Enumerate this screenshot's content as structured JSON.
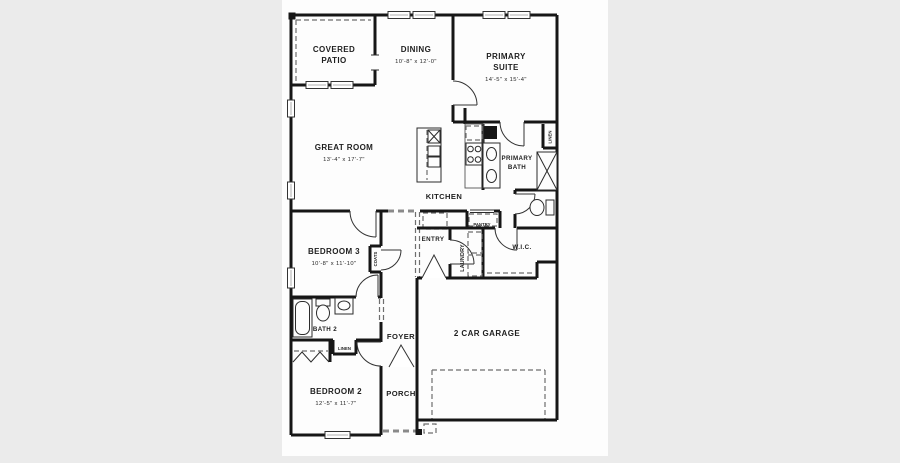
{
  "canvas": {
    "background": "#ebebeb",
    "paper": "#fdfdfd",
    "wall_color": "#161616",
    "text_color": "#1f1f1f"
  },
  "rooms": {
    "covered_patio": {
      "line1": "COVERED",
      "line2": "PATIO"
    },
    "dining": {
      "name": "DINING",
      "dims": "10'-8\" x 12'-0\""
    },
    "primary_suite": {
      "line1": "PRIMARY",
      "line2": "SUITE",
      "dims": "14'-5\" x 15'-4\""
    },
    "great_room": {
      "name": "GREAT ROOM",
      "dims": "13'-4\" x 17'-7\""
    },
    "kitchen": {
      "name": "KITCHEN"
    },
    "primary_bath": {
      "line1": "PRIMARY",
      "line2": "BATH"
    },
    "bedroom3": {
      "name": "BEDROOM 3",
      "dims": "10'-8\" x 11'-10\""
    },
    "bedroom2": {
      "name": "BEDROOM 2",
      "dims": "12'-5\" x 11'-7\""
    },
    "bath2": {
      "name": "BATH 2"
    },
    "foyer": {
      "name": "FOYER"
    },
    "porch": {
      "name": "PORCH"
    },
    "garage": {
      "name": "2 CAR GARAGE"
    },
    "entry": {
      "name": "ENTRY"
    },
    "laundry": {
      "name": "LAUNDRY"
    },
    "wic": {
      "name": "W.I.C."
    },
    "pantry": {
      "name": "PANTRY"
    },
    "coats": {
      "name": "COATS"
    },
    "linen_bath": {
      "name": "LINEN"
    },
    "linen_primary": {
      "name": "LINEN"
    }
  }
}
